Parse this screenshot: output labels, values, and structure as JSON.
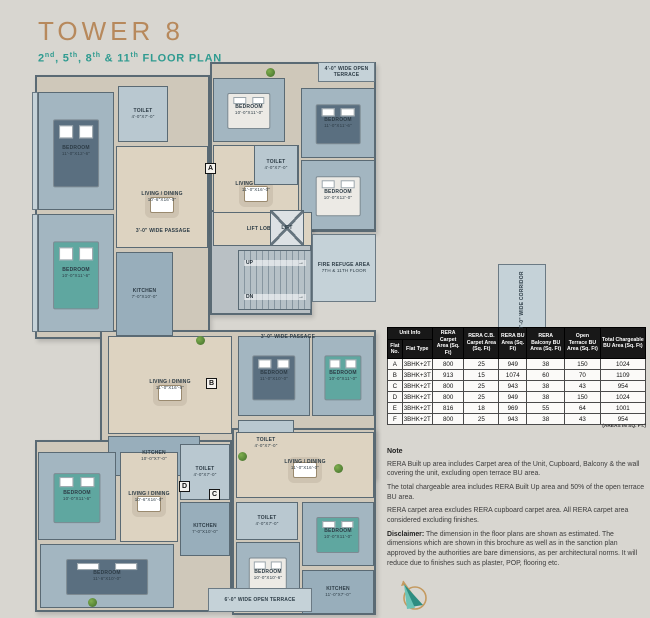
{
  "header": {
    "title": "TOWER 8",
    "subtitle_segments": [
      [
        "2",
        "nd"
      ],
      [
        ", 5",
        "th"
      ],
      [
        ", 8",
        "th"
      ],
      [
        " & 11",
        "th"
      ],
      [
        " FLOOR PLAN",
        ""
      ]
    ]
  },
  "table": {
    "group_header": "Unit Info",
    "columns": [
      "Flat No.",
      "Flat Type",
      "RERA Carpet Area (Sq. Ft)",
      "RERA C.B. Carpet Area (Sq. Ft)",
      "RERA BU Area (Sq. Ft)",
      "RERA Balcony BU Area (Sq. Ft)",
      "Open Terrace BU Area (Sq. Ft)",
      "Total Chargeable BU Area (Sq. Ft)"
    ],
    "rows": [
      [
        "A",
        "3BHK+2T",
        "800",
        "25",
        "949",
        "38",
        "150",
        "1024"
      ],
      [
        "B",
        "3BHK+3T",
        "913",
        "15",
        "1074",
        "60",
        "70",
        "1109"
      ],
      [
        "C",
        "3BHK+2T",
        "800",
        "25",
        "943",
        "38",
        "43",
        "954"
      ],
      [
        "D",
        "3BHK+2T",
        "800",
        "25",
        "949",
        "38",
        "150",
        "1024"
      ],
      [
        "E",
        "3BHK+2T",
        "816",
        "18",
        "969",
        "55",
        "64",
        "1001"
      ],
      [
        "F",
        "3BHK+2T",
        "800",
        "25",
        "943",
        "38",
        "43",
        "954"
      ]
    ],
    "footnote": "(AREAS IN SQ. FT.)"
  },
  "note": {
    "heading": "Note",
    "items": [
      "RERA Built up area includes Carpet area of the Unit, Cupboard, Balcony & the wall covering the unit, excluding open terrace BU area.",
      "The total chargeable area includes RERA Built Up area and 50% of the open terrace BU area.",
      "RERA carpet area excludes RERA cupboard carpet area. All RERA carpet area considered excluding finishes."
    ],
    "disclaimer_label": "Disclaimer:",
    "disclaimer": " The dimension in the floor plans are shown as estimated. The dimensions which are shown in this brochure as well as in the sanction plan approved by the authorities are bare dimensions, as per architectural norms. It will reduce due to finishes such as plaster, POP, flooring etc."
  },
  "plan": {
    "rooms": [
      {
        "type": "slab",
        "x": 35,
        "y": 75,
        "w": 175,
        "h": 264,
        "name": "unit-a-slab"
      },
      {
        "type": "slab",
        "x": 210,
        "y": 62,
        "w": 166,
        "h": 170,
        "name": "top-units-slab"
      },
      {
        "type": "slab core",
        "x": 210,
        "y": 210,
        "w": 102,
        "h": 105,
        "name": "core-slab"
      },
      {
        "type": "slab",
        "x": 100,
        "y": 330,
        "w": 276,
        "h": 148,
        "name": "unit-b-slab"
      },
      {
        "type": "slab",
        "x": 35,
        "y": 440,
        "w": 197,
        "h": 172,
        "name": "bottom-left-slab"
      },
      {
        "type": "slab",
        "x": 232,
        "y": 428,
        "w": 144,
        "h": 187,
        "name": "bottom-right-slab"
      },
      {
        "type": "terrace",
        "x": 498,
        "y": 264,
        "w": 48,
        "h": 72,
        "label": "7'-0\" WIDE CORRIDOR",
        "vert": true,
        "name": "side-corridor"
      },
      {
        "type": "terrace",
        "x": 32,
        "y": 92,
        "w": 6,
        "h": 118,
        "name": "balcony-strip"
      },
      {
        "type": "terrace",
        "x": 32,
        "y": 214,
        "w": 6,
        "h": 118,
        "name": "balcony-strip"
      },
      {
        "type": "room",
        "x": 38,
        "y": 92,
        "w": 76,
        "h": 118,
        "label": "BEDROOM",
        "dims": "11'-0\"X12'-6\"",
        "bed": true,
        "bedv": "dark",
        "name": "bedroom"
      },
      {
        "type": "room",
        "x": 38,
        "y": 214,
        "w": 76,
        "h": 118,
        "label": "BEDROOM",
        "dims": "10'-0\"X11'-6\"",
        "bed": true,
        "bedv": "teal",
        "name": "bedroom"
      },
      {
        "type": "toilet",
        "x": 118,
        "y": 86,
        "w": 50,
        "h": 56,
        "label": "TOILET",
        "dims": "4'-0\"X7'-0\"",
        "name": "toilet"
      },
      {
        "type": "living",
        "x": 116,
        "y": 146,
        "w": 92,
        "h": 102,
        "label": "LIVING / DINING",
        "dims": "10'-6\"X16'-0\"",
        "table": true,
        "name": "living-dining"
      },
      {
        "type": "kitchen",
        "x": 116,
        "y": 252,
        "w": 57,
        "h": 84,
        "label": "KITCHEN",
        "dims": "7'-0\"X10'-0\"",
        "name": "kitchen"
      },
      {
        "type": "labelonly",
        "x": 118,
        "y": 226,
        "w": 90,
        "h": 10,
        "label": "3'-0\" WIDE PASSAGE",
        "name": "passage-label"
      },
      {
        "type": "room",
        "x": 213,
        "y": 78,
        "w": 72,
        "h": 64,
        "label": "BEDROOM",
        "dims": "10'-0\"X11'-0\"",
        "bed": true,
        "name": "bedroom"
      },
      {
        "type": "living",
        "x": 213,
        "y": 145,
        "w": 86,
        "h": 84,
        "label": "LIVING / DINING",
        "dims": "11'-0\"X16'-0\"",
        "table": true,
        "name": "living-dining"
      },
      {
        "type": "toilet",
        "x": 254,
        "y": 145,
        "w": 44,
        "h": 40,
        "label": "TOILET",
        "dims": "4'-0\"X7'-0\"",
        "z": 2,
        "name": "toilet"
      },
      {
        "type": "room",
        "x": 301,
        "y": 88,
        "w": 74,
        "h": 70,
        "label": "BEDROOM",
        "dims": "11'-0\"X11'-6\"",
        "bed": true,
        "bedv": "dark",
        "name": "bedroom"
      },
      {
        "type": "room",
        "x": 301,
        "y": 160,
        "w": 74,
        "h": 70,
        "label": "BEDROOM",
        "dims": "10'-0\"X12'-0\"",
        "bed": true,
        "name": "bedroom"
      },
      {
        "type": "terrace",
        "x": 318,
        "y": 62,
        "w": 57,
        "h": 20,
        "label": "4'-0\" WIDE OPEN TERRACE",
        "name": "open-terrace"
      },
      {
        "type": "living",
        "x": 213,
        "y": 212,
        "w": 99,
        "h": 34,
        "label": "LIFT LOBBY",
        "name": "lift-lobby"
      },
      {
        "type": "lift",
        "x": 270,
        "y": 210,
        "w": 34,
        "h": 36,
        "label": "LIFT",
        "z": 2,
        "name": "lift"
      },
      {
        "type": "stairs",
        "x": 238,
        "y": 250,
        "w": 74,
        "h": 60,
        "up": "UP",
        "dn": "DN",
        "name": "staircase"
      },
      {
        "type": "terrace",
        "x": 312,
        "y": 234,
        "w": 64,
        "h": 68,
        "label": "FIRE REFUGE AREA",
        "dims": "7TH & 11TH FLOOR",
        "name": "fire-refuge-area"
      },
      {
        "type": "living",
        "x": 108,
        "y": 336,
        "w": 124,
        "h": 98,
        "label": "LIVING / DINING",
        "dims": "11'-0\"X16'-6\"",
        "table": true,
        "name": "living-dining"
      },
      {
        "type": "room",
        "x": 238,
        "y": 336,
        "w": 72,
        "h": 80,
        "label": "BEDROOM",
        "dims": "11'-0\"X10'-0\"",
        "bed": true,
        "bedv": "dark",
        "name": "bedroom"
      },
      {
        "type": "room",
        "x": 312,
        "y": 336,
        "w": 62,
        "h": 80,
        "label": "BEDROOM",
        "dims": "10'-0\"X11'-0\"",
        "bed": true,
        "bedv": "teal",
        "name": "bedroom"
      },
      {
        "type": "kitchen",
        "x": 108,
        "y": 436,
        "w": 92,
        "h": 40,
        "label": "KITCHEN",
        "dims": "10'-0\"X7'-0\"",
        "name": "kitchen"
      },
      {
        "type": "toilet",
        "x": 238,
        "y": 420,
        "w": 56,
        "h": 46,
        "label": "TOILET",
        "dims": "4'-0\"X7'-0\"",
        "name": "toilet"
      },
      {
        "type": "labelonly",
        "x": 238,
        "y": 332,
        "w": 100,
        "h": 10,
        "label": "3'-0\" WIDE PASSAGE",
        "name": "passage-label"
      },
      {
        "type": "room",
        "x": 38,
        "y": 452,
        "w": 78,
        "h": 88,
        "label": "BEDROOM",
        "dims": "10'-0\"X11'-6\"",
        "bed": true,
        "bedv": "teal",
        "name": "bedroom"
      },
      {
        "type": "room",
        "x": 40,
        "y": 544,
        "w": 134,
        "h": 64,
        "label": "BEDROOM",
        "dims": "11'-6\"X10'-0\"",
        "bed": true,
        "bedv": "dark",
        "name": "bedroom"
      },
      {
        "type": "toilet",
        "x": 180,
        "y": 444,
        "w": 50,
        "h": 56,
        "label": "TOILET",
        "dims": "4'-0\"X7'-0\"",
        "name": "toilet"
      },
      {
        "type": "kitchen",
        "x": 180,
        "y": 502,
        "w": 50,
        "h": 54,
        "label": "KITCHEN",
        "dims": "7'-0\"X10'-0\"",
        "name": "kitchen"
      },
      {
        "type": "living",
        "x": 120,
        "y": 452,
        "w": 58,
        "h": 90,
        "label": "LIVING / DINING",
        "dims": "10'-6\"X16'-0\"",
        "table": true,
        "name": "living-dining"
      },
      {
        "type": "living",
        "x": 236,
        "y": 432,
        "w": 138,
        "h": 66,
        "label": "LIVING / DINING",
        "dims": "11'-0\"X16'-0\"",
        "table": true,
        "name": "living-dining"
      },
      {
        "type": "toilet",
        "x": 236,
        "y": 502,
        "w": 62,
        "h": 38,
        "label": "TOILET",
        "dims": "4'-0\"X7'-0\"",
        "name": "toilet"
      },
      {
        "type": "room",
        "x": 236,
        "y": 542,
        "w": 64,
        "h": 66,
        "label": "BEDROOM",
        "dims": "10'-0\"X10'-6\"",
        "bed": true,
        "name": "bedroom"
      },
      {
        "type": "room",
        "x": 302,
        "y": 502,
        "w": 72,
        "h": 64,
        "label": "BEDROOM",
        "dims": "10'-0\"X11'-0\"",
        "bed": true,
        "bedv": "teal",
        "name": "bedroom"
      },
      {
        "type": "kitchen",
        "x": 302,
        "y": 570,
        "w": 72,
        "h": 44,
        "label": "KITCHEN",
        "dims": "11'-0\"X7'-0\"",
        "name": "kitchen"
      },
      {
        "type": "terrace",
        "x": 208,
        "y": 588,
        "w": 104,
        "h": 24,
        "label": "6'-0\" WIDE OPEN TERRACE",
        "z": 2,
        "name": "open-terrace"
      }
    ],
    "markers": [
      {
        "label": "A",
        "x": 205,
        "y": 163
      },
      {
        "label": "B",
        "x": 206,
        "y": 378
      },
      {
        "label": "D",
        "x": 179,
        "y": 481
      },
      {
        "label": "C",
        "x": 209,
        "y": 489
      }
    ],
    "plants": [
      {
        "x": 266,
        "y": 68
      },
      {
        "x": 238,
        "y": 452
      },
      {
        "x": 88,
        "y": 598
      },
      {
        "x": 334,
        "y": 464
      },
      {
        "x": 196,
        "y": 336
      }
    ]
  },
  "compass": {
    "name": "north-compass"
  }
}
